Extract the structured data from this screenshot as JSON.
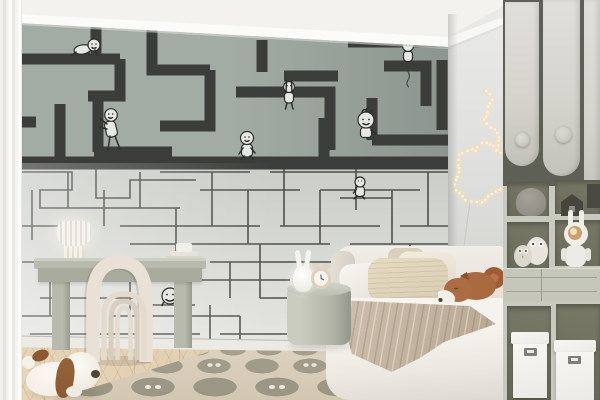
{
  "scene": {
    "type": "interior-photo",
    "room": "kids-bedroom",
    "description": "Children's bedroom with a maze wall mural featuring small cartoon figures, a desk with sculptural arch chair, corner bed with plush fox, round side table, string lights and a storage shelving unit"
  },
  "colors": {
    "mural-green": "#a3aba5",
    "mural-path": "#e8eae5",
    "mural-line": "#3b3d3a",
    "mural-pale": "#d3d6d1",
    "wall-right": "#dcdcda",
    "ceiling": "#f3f2ef",
    "cabinet-door": "#d4d3cc",
    "shelf-frame": "#c9cabf",
    "shelf-interior": "#6a6b5a",
    "drawer": "#c6c7bb",
    "bed": "#e2dcd3",
    "knit-pillow": "#d8cdb3",
    "blanket": "#b3a38e",
    "fox-plush": "#a96a40",
    "rug-base": "#d2c7b2",
    "rug-pebble": "#a5a08e",
    "floor": "#d9c4a6",
    "desk": "#b7baac",
    "chair": "#e9e1d5",
    "lamp": "#f6f4ef",
    "dog-body": "#eee8de",
    "dog-ear": "#8b5a33",
    "side-table": "#b3b5a9",
    "box-white": "#ebeae6",
    "light-warm": "#fff3da"
  },
  "mural": {
    "style": "maze wallpaper, white corridors on sage green above, dark line maze on pale grey below",
    "characters": [
      {
        "name": "crawling-figure",
        "area": "top-left"
      },
      {
        "name": "leaning-figure",
        "area": "upper-left"
      },
      {
        "name": "walking-figure",
        "area": "center-band"
      },
      {
        "name": "hanging-figure",
        "area": "upper-center"
      },
      {
        "name": "big-head-figure",
        "area": "upper-right"
      },
      {
        "name": "dangling-figure",
        "area": "top-right"
      },
      {
        "name": "small-sitting-figure",
        "area": "middle-right"
      },
      {
        "name": "doodle-face",
        "area": "behind-desk"
      }
    ]
  },
  "furniture": [
    "desk",
    "arch-chair",
    "corner-bed",
    "round-side-table",
    "storage-shelving-unit"
  ],
  "decor": [
    "pleated-table-lamp",
    "alarm-clock",
    "bunny-lamp",
    "fox-plush-on-bed",
    "dog-plush-on-floor",
    "owl-plushes",
    "bunny-robot-lamp",
    "string-lights",
    "pebble-pattern-rug",
    "sheer-curtain",
    "white-storage-boxes"
  ]
}
